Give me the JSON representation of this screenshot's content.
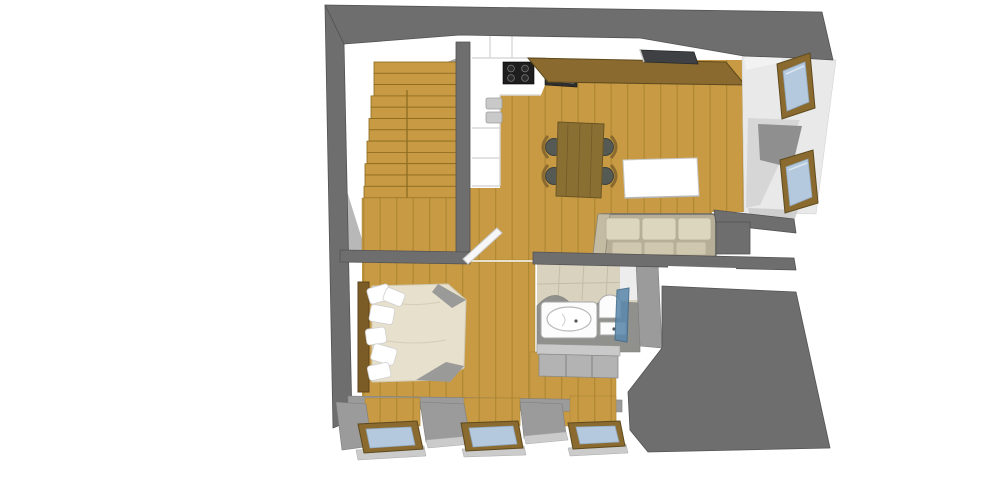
{
  "scene": {
    "title": "attic-apartment-3d-floor-plan",
    "rooms": [
      {
        "name": "staircase"
      },
      {
        "name": "kitchen"
      },
      {
        "name": "dining-area"
      },
      {
        "name": "living-area"
      },
      {
        "name": "hallway"
      },
      {
        "name": "bedroom"
      },
      {
        "name": "bathroom"
      }
    ],
    "furniture": [
      "stair-flights",
      "stair-landing",
      "kitchen-cooktop",
      "kitchen-oven",
      "kitchen-sink",
      "kitchen-cabinets",
      "breakfast-bar",
      "roof-skylight",
      "dining-table",
      "dining-chair",
      "coffee-table",
      "sofa",
      "bed",
      "pillows",
      "headboard",
      "bathtub",
      "toilet",
      "wash-basin",
      "shower-screen",
      "vanity-cabinets",
      "open-door"
    ],
    "window_counts": {
      "right_dormer_windows": 2,
      "bottom_roof_windows": 3
    },
    "cooktop_burners": 4,
    "dining_chair_count": 4,
    "sofa_seat_count": 3
  },
  "palette": {
    "wall_dark": "#6E6E6E",
    "wall_mid": "#9B9B9B",
    "wall_light": "#CBCBCB",
    "outline": "#555252",
    "floor_wood": "#C79A43",
    "plank_line": "#A6802C",
    "stair_line": "#8A6A1F",
    "tread_hi": "#D9B367",
    "wood_dark": "#8A6A2E",
    "wood_darker": "#5E4A1E",
    "glass": "#B5C9DE",
    "glass_edge": "#8FA8BE",
    "glass_shower": "#5D89AC",
    "kitchen_line": "#D8D8D8",
    "cooktop": "#1E1E1E",
    "appliance": "#2E2E2E",
    "sofa_frame": "#B7AE98",
    "cushion": "#DDD6BF",
    "cushion2": "#CFC7AE",
    "duvet": "#E7E0CC",
    "duvet_line": "#CFC8B2",
    "fold": "#9A9A98",
    "table": "#8A6F33",
    "table_line": "#74592A",
    "seat": "#565A54",
    "tile": "#D9D2BF",
    "tile_line": "#C4BCA6",
    "wet": "#90918D",
    "fixture": "#FCFCFC",
    "fixture_line": "#A8A8A8",
    "skylight": "#3E4043",
    "vanity": "#B3B3B3",
    "vanity_top": "#C9C9C9"
  }
}
